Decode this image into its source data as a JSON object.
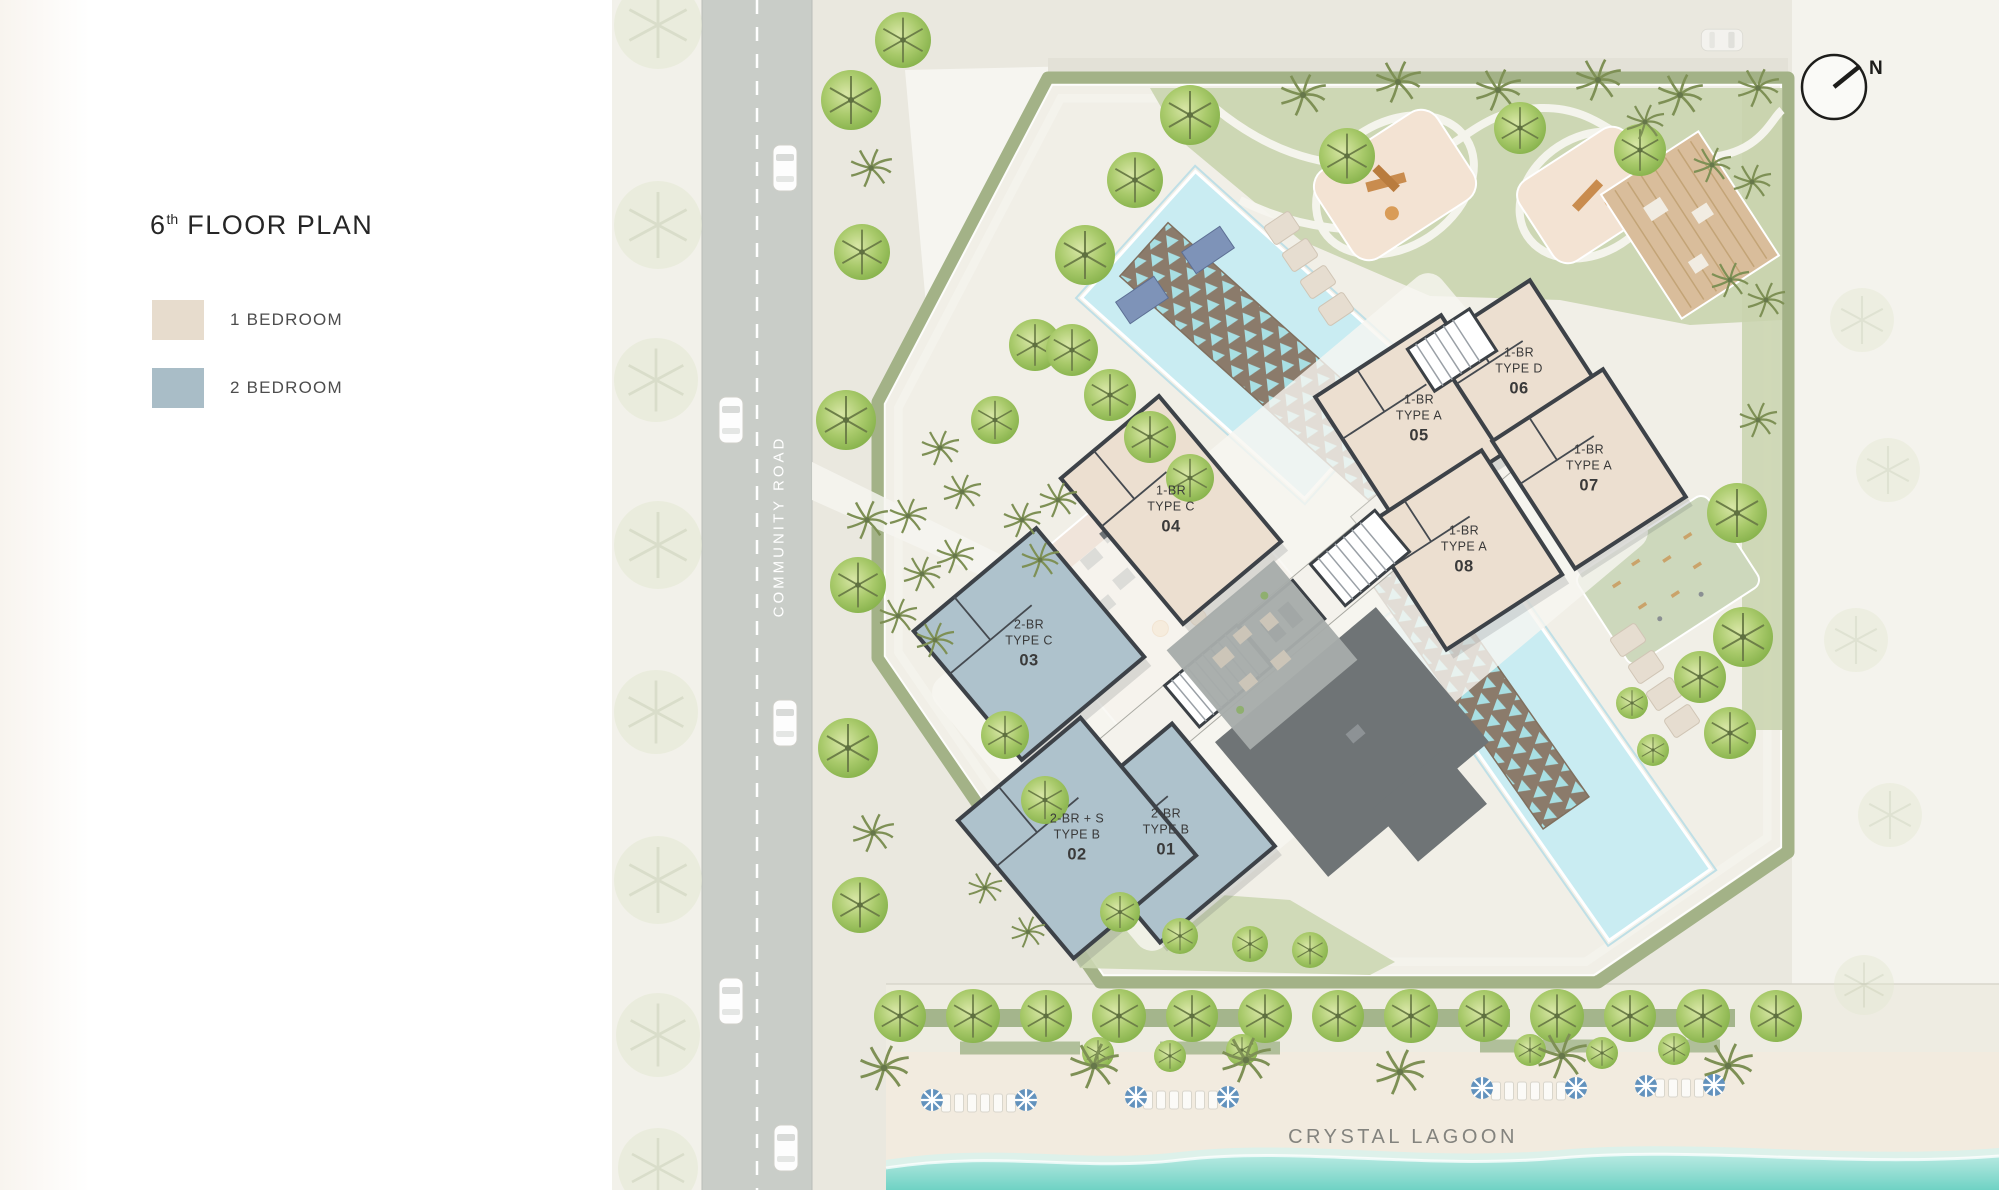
{
  "title": {
    "number": "6",
    "ordinal": "th",
    "text": "FLOOR PLAN"
  },
  "legend": {
    "items": [
      {
        "label": "1 BEDROOM",
        "color": "#e7dccd"
      },
      {
        "label": "2 BEDROOM",
        "color": "#a9bdc7"
      }
    ]
  },
  "labels": {
    "road": "COMMUNITY ROAD",
    "lagoon": "CRYSTAL LAGOON",
    "compass_north": "N"
  },
  "units": [
    {
      "id": "01",
      "line1": "2-BR",
      "line2": "TYPE B",
      "num": "01",
      "bedrooms": 2
    },
    {
      "id": "02",
      "line1": "2-BR + S",
      "line2": "TYPE B",
      "num": "02",
      "bedrooms": 2
    },
    {
      "id": "03",
      "line1": "2-BR",
      "line2": "TYPE C",
      "num": "03",
      "bedrooms": 2
    },
    {
      "id": "04",
      "line1": "1-BR",
      "line2": "TYPE C",
      "num": "04",
      "bedrooms": 1
    },
    {
      "id": "05",
      "line1": "1-BR",
      "line2": "TYPE A",
      "num": "05",
      "bedrooms": 1
    },
    {
      "id": "06",
      "line1": "1-BR",
      "line2": "TYPE D",
      "num": "06",
      "bedrooms": 1
    },
    {
      "id": "07",
      "line1": "1-BR",
      "line2": "TYPE A",
      "num": "07",
      "bedrooms": 1
    },
    {
      "id": "08",
      "line1": "1-BR",
      "line2": "TYPE A",
      "num": "08",
      "bedrooms": 1
    }
  ],
  "palette": {
    "one_bedroom": "#e7dccd",
    "two_bedroom": "#a9bdc7",
    "walls": "#3d4248",
    "pool_water": "#c9ecf2",
    "mosaic_runner": "#8b7b6b",
    "hedge_green": "#a3b287",
    "lawn_green": "#c9d4ae",
    "road_gray": "#c9cdc8",
    "sand": "#f2ebdf",
    "lagoon_water": "#7fd6ca",
    "deck_gray": "#6f7476"
  }
}
